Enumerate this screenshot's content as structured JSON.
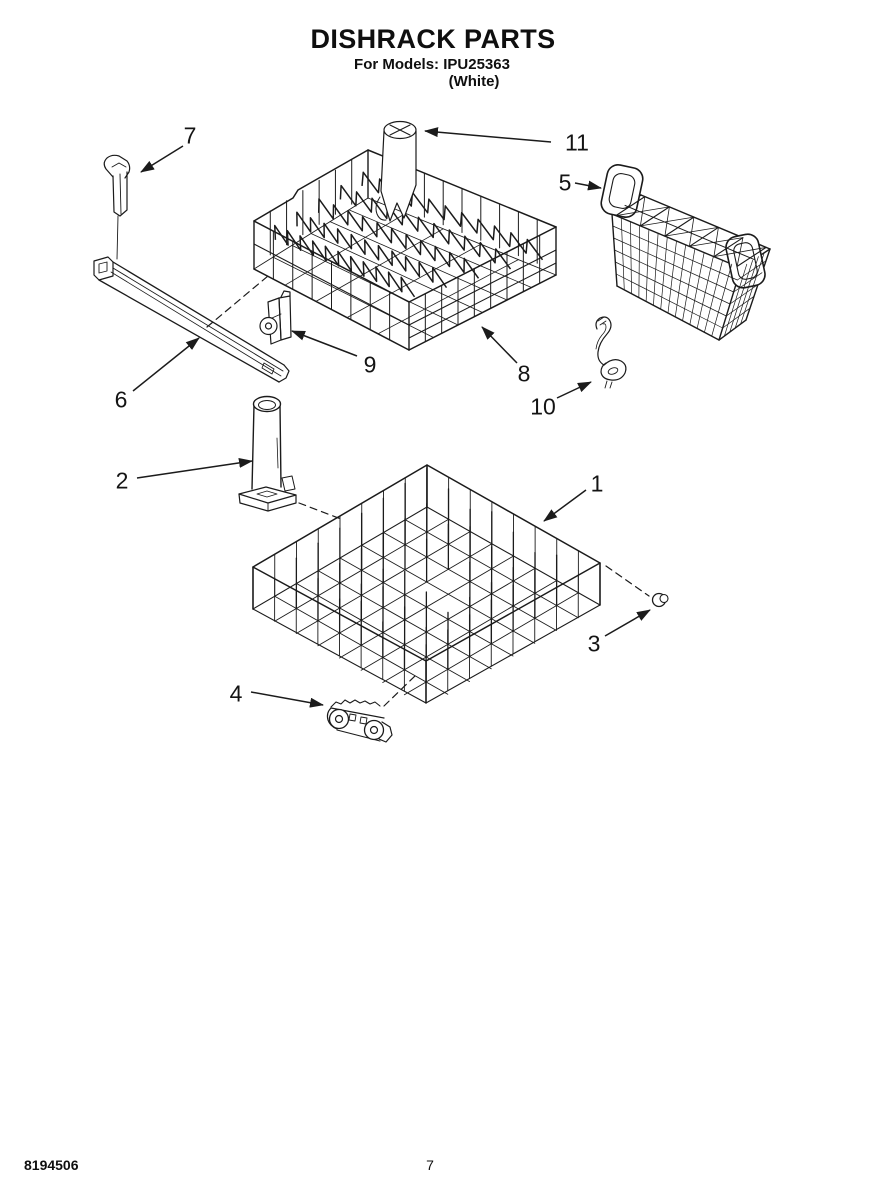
{
  "page": {
    "title": "DISHRACK PARTS",
    "models_line": "For Models: IPU25363",
    "color_line": "(White)",
    "doc_number": "8194506",
    "page_number": "7"
  },
  "diagram": {
    "callouts": [
      {
        "label": "1"
      },
      {
        "label": "2"
      },
      {
        "label": "3"
      },
      {
        "label": "4"
      },
      {
        "label": "5"
      },
      {
        "label": "6"
      },
      {
        "label": "7"
      },
      {
        "label": "8"
      },
      {
        "label": "9"
      },
      {
        "label": "10"
      },
      {
        "label": "11"
      }
    ]
  }
}
